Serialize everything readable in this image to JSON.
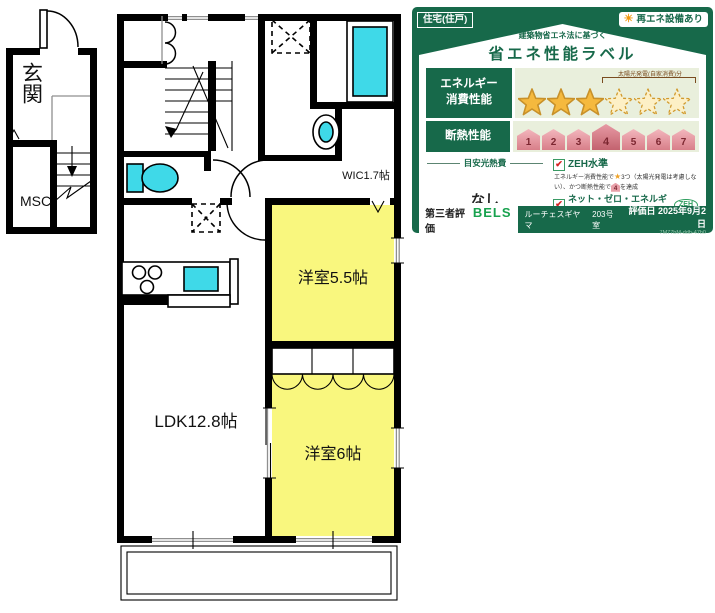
{
  "floorplan": {
    "entrance": "玄関",
    "storage": "MSC",
    "wic": "WIC1.7帖",
    "bedroom_55": "洋室5.5帖",
    "ldk": "LDK12.8帖",
    "bedroom_6": "洋室6帖"
  },
  "energy_label": {
    "housing_type": "住宅(住戸)",
    "sun_icon": "☀",
    "renewable_badge": "再エネ設備あり",
    "law_note": "建築物省エネ法に基づく",
    "title": "省エネ性能ラベル",
    "energy_row_line1": "エネルギー",
    "energy_row_line2": "消費性能",
    "stars_filled": 3,
    "stars_solar_outline": 3,
    "solar_note": "太陽光発電(自家消費)分",
    "insulation_row_label": "断熱性能",
    "insulation_grades": [
      1,
      2,
      3,
      4,
      5,
      6,
      7
    ],
    "insulation_achieved": 4,
    "cost_heading": "目安光熱費",
    "cost_value": "なし",
    "check": "✔",
    "zeh_heading": "ZEH水準",
    "zeh_desc_pre": "エネルギー消費性能で",
    "zeh_desc_star": "★",
    "zeh_desc_mid": "3つ（太陽光発電は考慮しない）、かつ断熱性能で",
    "zeh_desc_grade": "4",
    "zeh_desc_post": "を達成",
    "nze_heading": "ネット・ゼロ・エネルギー",
    "zeh_badge": "ZEH",
    "nze_desc": "太陽光発電の売電分も含めてエネルギー収支がゼロ以下を達成",
    "cert_label": "第三者評価",
    "cert_brand": "BELS",
    "building_name": "ルーチェスギヤマ",
    "unit": "203号室",
    "eval_date": "評価日 2025年9月2日",
    "eval_code": "7M77bM-ddb-47b0",
    "colors": {
      "green": "#17694a",
      "pale": "#e9efdc",
      "gold": "#f5b93e",
      "house_pink": "#e08a94",
      "yellow": "#f9f77e",
      "cyan": "#3fd9e8"
    }
  }
}
